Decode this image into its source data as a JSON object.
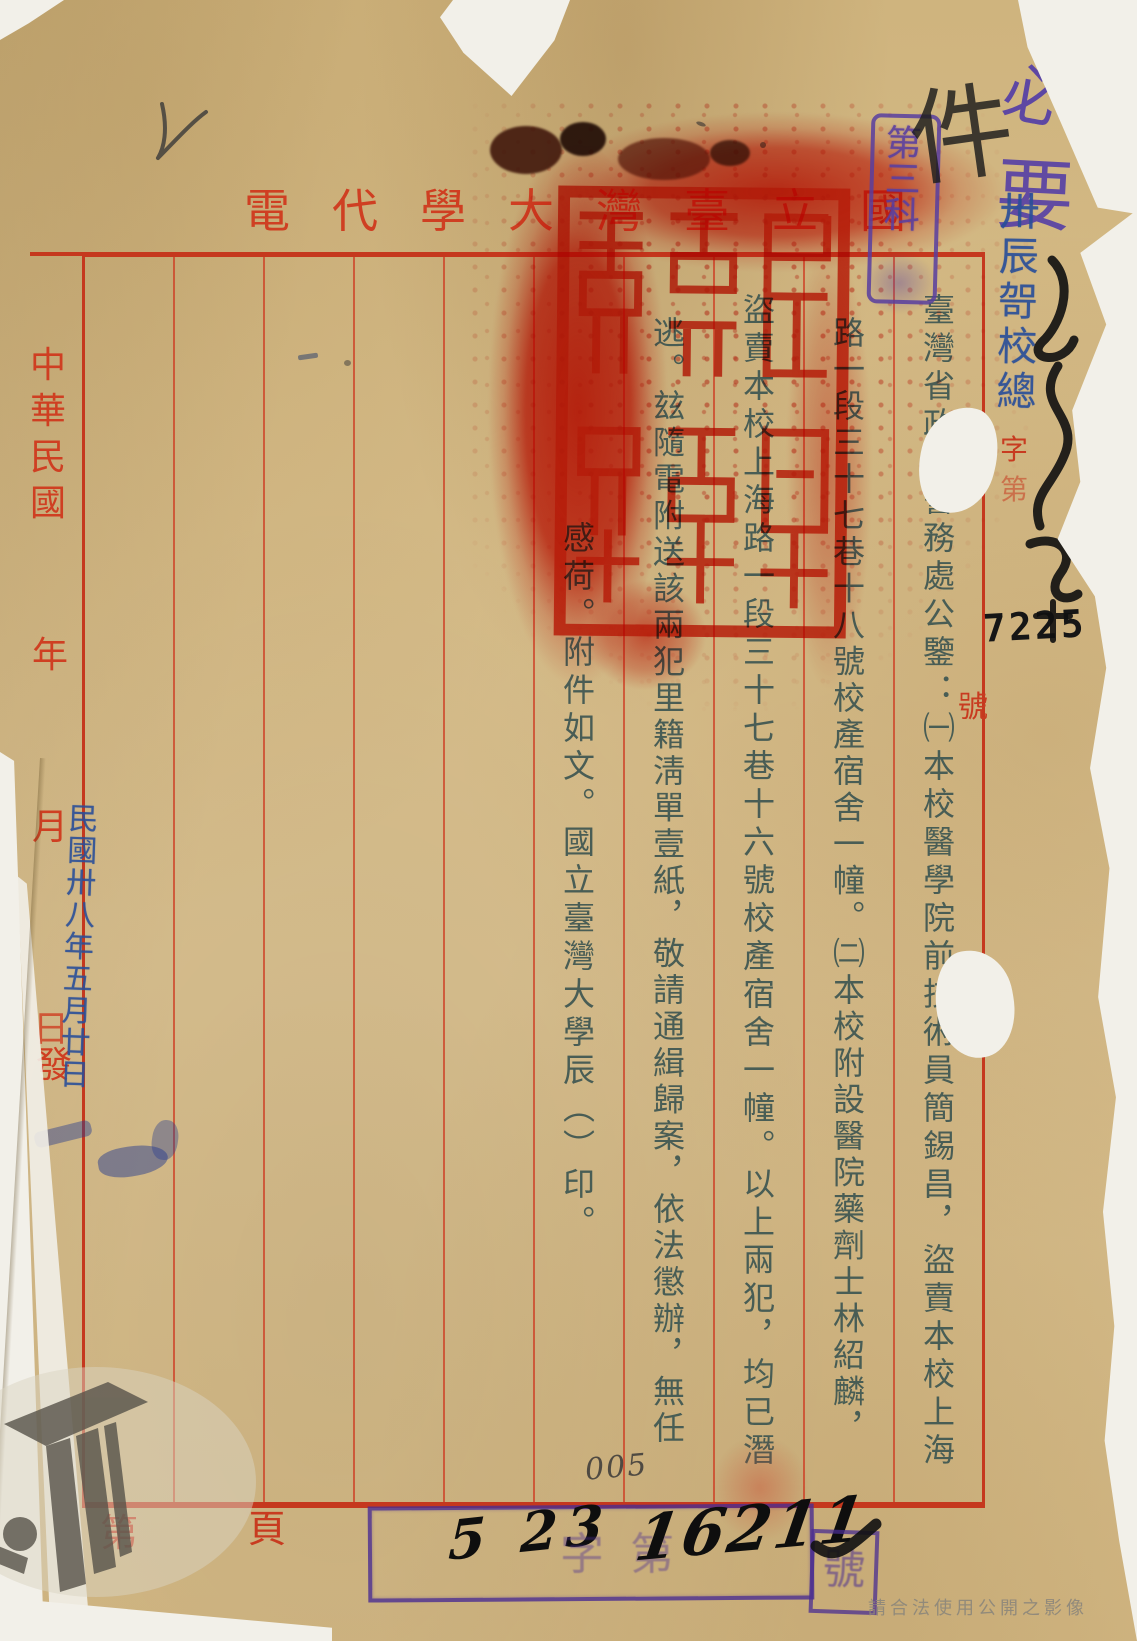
{
  "page": {
    "header": {
      "title_full": "國立臺灣大學代電",
      "chars": [
        "國",
        "立",
        "臺",
        "灣",
        "大",
        "學",
        "代",
        "電"
      ]
    },
    "margin_left": {
      "era": [
        "中",
        "華",
        "民",
        "國"
      ],
      "year": "年",
      "month": "月",
      "day": "日",
      "issue": "發"
    },
    "margin_right": {
      "zi": "字",
      "di": "第",
      "hao": "號"
    },
    "body_columns": [
      "臺灣省政府警務處公鑒：㈠本校醫學院前技術員簡錫昌，盜賣本校上海",
      "路一段三十七巷十八號校產宿舍一幢。㈡本校附設醫院藥劑士林紹麟，",
      "盜賣本校上海路一段三十七巷十六號校產宿舍一幢。以上兩犯，均已潛",
      "逃。玆隨電附送該兩犯里籍淸單壹紙，敬請通緝歸案，依法懲辦，無任",
      "感荷。附件如文。國立臺灣大學辰（）印。"
    ],
    "footer": {
      "di": "第",
      "page": "頁"
    },
    "stamps": {
      "dept": "第三科",
      "receive_code": "卅辰哿校總",
      "receive_no": "7225",
      "date": "民國卅八年五月廿日",
      "registry_hand_date": "5 23",
      "registry_faint": "字第",
      "registry_no": "16211",
      "registry_hao": "號"
    },
    "annotations": {
      "purple_top": "必要",
      "black_top": "件",
      "pencil_no": "005"
    },
    "watermark_notice": "請合法使用公開之影像",
    "colors": {
      "form_red": "#c83b20",
      "seal_red": "#e0301b",
      "ink": "#3f5752",
      "stamp_blue": "#2a4f99",
      "stamp_purple": "#5a3fa0",
      "paper": "#d6bd8a"
    }
  }
}
